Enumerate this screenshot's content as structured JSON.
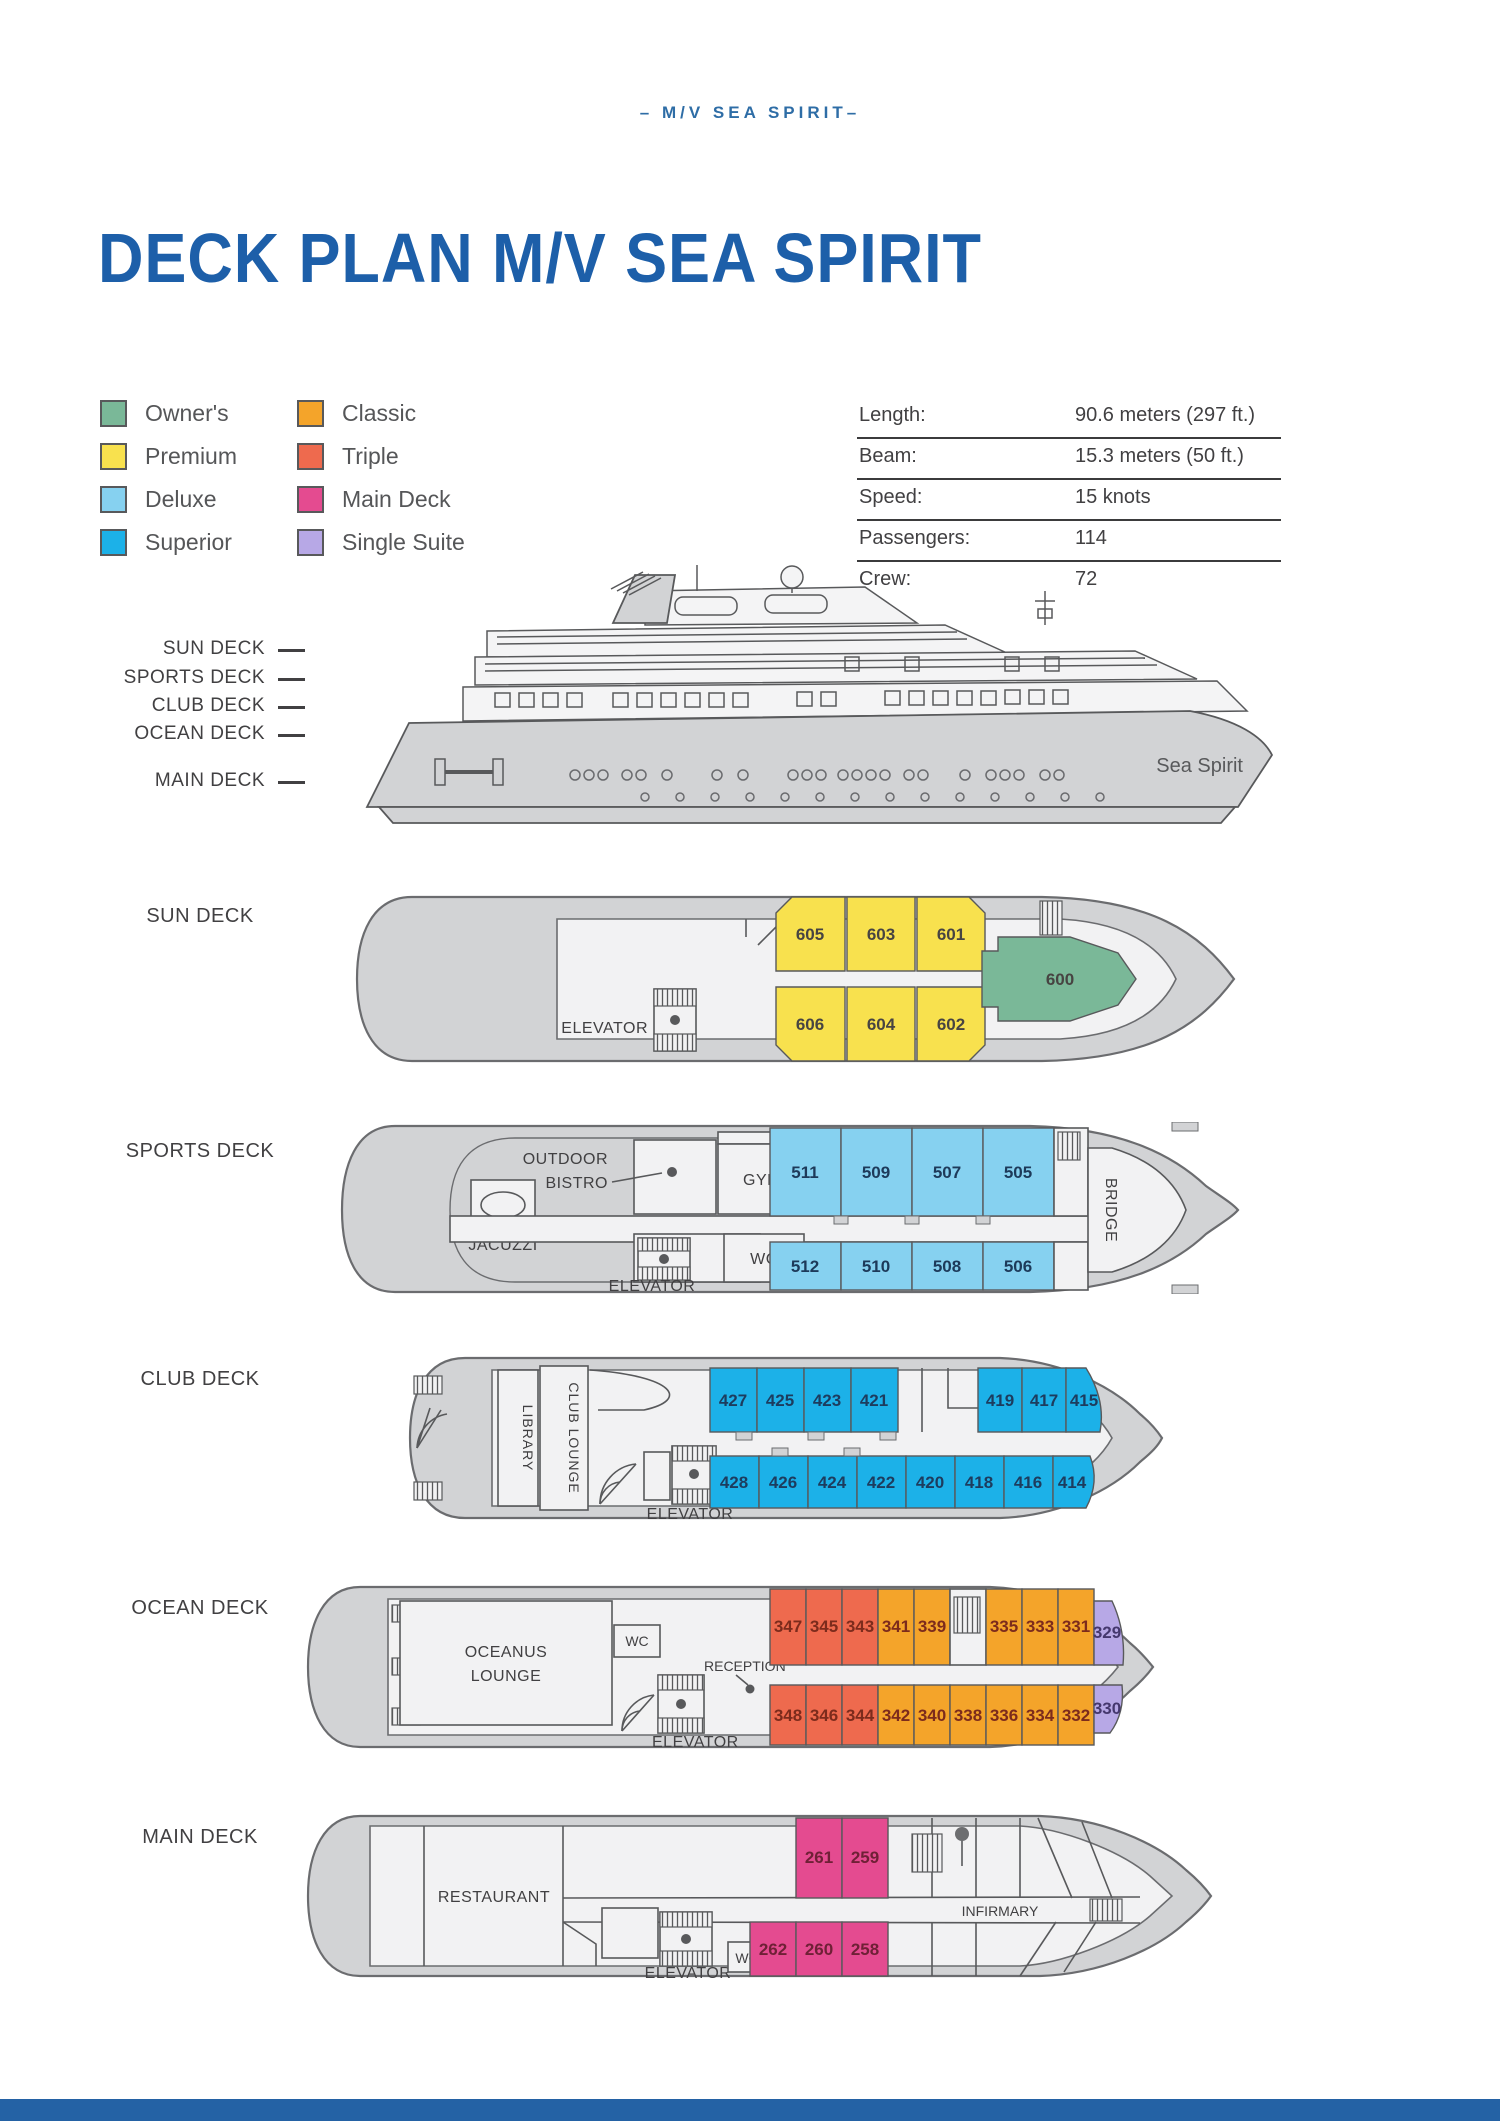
{
  "page": {
    "header": "– M/V SEA SPIRIT–",
    "title": "DECK PLAN M/V SEA SPIRIT"
  },
  "categories": {
    "owners": "#7ab898",
    "premium": "#f8e14e",
    "deluxe": "#86d1f0",
    "superior": "#1cb1e8",
    "classic": "#f4a42a",
    "triple": "#ee6a4e",
    "main_deck": "#e44b90",
    "single_suite": "#b7a8e6"
  },
  "legend": {
    "items": [
      {
        "label": "Owner's",
        "color": "#7ab898"
      },
      {
        "label": "Premium",
        "color": "#f8e14e"
      },
      {
        "label": "Deluxe",
        "color": "#86d1f0"
      },
      {
        "label": "Superior",
        "color": "#1cb1e8"
      },
      {
        "label": "Classic",
        "color": "#f4a42a"
      },
      {
        "label": "Triple",
        "color": "#ee6a4e"
      },
      {
        "label": "Main Deck",
        "color": "#e44b90"
      },
      {
        "label": "Single Suite",
        "color": "#b7a8e6"
      }
    ]
  },
  "specs": {
    "rows": [
      {
        "label": "Length:",
        "value": "90.6 meters (297 ft.)"
      },
      {
        "label": "Beam:",
        "value": "15.3 meters (50 ft.)"
      },
      {
        "label": "Speed:",
        "value": "15 knots"
      },
      {
        "label": "Passengers:",
        "value": "114"
      },
      {
        "label": "Crew:",
        "value": "72"
      }
    ]
  },
  "profile": {
    "ship_name": "Sea Spirit",
    "deck_labels": [
      "SUN DECK",
      "SPORTS DECK",
      "CLUB DECK",
      "OCEAN DECK",
      "MAIN DECK"
    ]
  },
  "decks": {
    "sun": {
      "label": "SUN DECK",
      "elevator": "ELEVATOR",
      "cabins": [
        {
          "number": "605",
          "category": "Premium"
        },
        {
          "number": "603",
          "category": "Premium"
        },
        {
          "number": "601",
          "category": "Premium"
        },
        {
          "number": "606",
          "category": "Premium"
        },
        {
          "number": "604",
          "category": "Premium"
        },
        {
          "number": "602",
          "category": "Premium"
        },
        {
          "number": "600",
          "category": "Owner's"
        }
      ]
    },
    "sports": {
      "label": "SPORTS DECK",
      "outdoor_bistro": [
        "OUTDOOR",
        "BISTRO"
      ],
      "gym": "GYM",
      "jacuzzi": "JACUZZI",
      "wc": "WC",
      "elevator": "ELEVATOR",
      "bridge": "BRIDGE",
      "cabins": [
        {
          "number": "511",
          "category": "Deluxe"
        },
        {
          "number": "509",
          "category": "Deluxe"
        },
        {
          "number": "507",
          "category": "Deluxe"
        },
        {
          "number": "505",
          "category": "Deluxe"
        },
        {
          "number": "512",
          "category": "Deluxe"
        },
        {
          "number": "510",
          "category": "Deluxe"
        },
        {
          "number": "508",
          "category": "Deluxe"
        },
        {
          "number": "506",
          "category": "Deluxe"
        }
      ]
    },
    "club": {
      "label": "CLUB DECK",
      "library": "LIBRARY",
      "club_lounge": "CLUB LOUNGE",
      "elevator": "ELEVATOR",
      "cabins_top": [
        {
          "number": "427",
          "category": "Superior"
        },
        {
          "number": "425",
          "category": "Superior"
        },
        {
          "number": "423",
          "category": "Superior"
        },
        {
          "number": "421",
          "category": "Superior"
        },
        {
          "number": "419",
          "category": "Superior"
        },
        {
          "number": "417",
          "category": "Superior"
        },
        {
          "number": "415",
          "category": "Superior"
        }
      ],
      "cabins_bottom": [
        {
          "number": "428",
          "category": "Superior"
        },
        {
          "number": "426",
          "category": "Superior"
        },
        {
          "number": "424",
          "category": "Superior"
        },
        {
          "number": "422",
          "category": "Superior"
        },
        {
          "number": "420",
          "category": "Superior"
        },
        {
          "number": "418",
          "category": "Superior"
        },
        {
          "number": "416",
          "category": "Superior"
        },
        {
          "number": "414",
          "category": "Superior"
        }
      ]
    },
    "ocean": {
      "label": "OCEAN DECK",
      "lounge": [
        "OCEANUS",
        "LOUNGE"
      ],
      "wc": "WC",
      "reception": "RECEPTION",
      "elevator": "ELEVATOR",
      "cabins_top": [
        {
          "number": "347",
          "category": "Triple"
        },
        {
          "number": "345",
          "category": "Triple"
        },
        {
          "number": "343",
          "category": "Triple"
        },
        {
          "number": "341",
          "category": "Classic"
        },
        {
          "number": "339",
          "category": "Classic"
        },
        {
          "number": "335",
          "category": "Classic"
        },
        {
          "number": "333",
          "category": "Classic"
        },
        {
          "number": "331",
          "category": "Classic"
        },
        {
          "number": "329",
          "category": "Single Suite"
        }
      ],
      "cabins_bottom": [
        {
          "number": "348",
          "category": "Triple"
        },
        {
          "number": "346",
          "category": "Triple"
        },
        {
          "number": "344",
          "category": "Triple"
        },
        {
          "number": "342",
          "category": "Classic"
        },
        {
          "number": "340",
          "category": "Classic"
        },
        {
          "number": "338",
          "category": "Classic"
        },
        {
          "number": "336",
          "category": "Classic"
        },
        {
          "number": "334",
          "category": "Classic"
        },
        {
          "number": "332",
          "category": "Classic"
        },
        {
          "number": "330",
          "category": "Single Suite"
        }
      ]
    },
    "main": {
      "label": "MAIN DECK",
      "restaurant": "RESTAURANT",
      "elevator": "ELEVATOR",
      "wc": "WC",
      "infirmary": "INFIRMARY",
      "cabins_top": [
        {
          "number": "261",
          "category": "Main Deck"
        },
        {
          "number": "259",
          "category": "Main Deck"
        }
      ],
      "cabins_bottom": [
        {
          "number": "262",
          "category": "Main Deck"
        },
        {
          "number": "260",
          "category": "Main Deck"
        },
        {
          "number": "258",
          "category": "Main Deck"
        }
      ]
    }
  }
}
